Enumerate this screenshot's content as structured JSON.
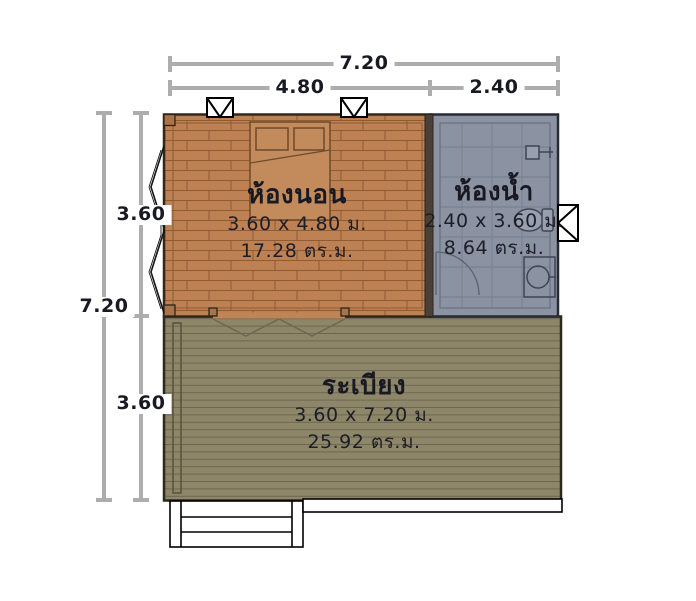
{
  "plan": {
    "dimensions": {
      "top_total": "7.20",
      "top_left": "4.80",
      "top_right": "2.40",
      "left_total": "7.20",
      "left_upper": "3.60",
      "left_lower": "3.60"
    },
    "rooms": {
      "bedroom": {
        "name": "ห้องนอน",
        "size": "3.60 x 4.80 ม.",
        "area": "17.28 ตร.ม.",
        "fill": "#be8153"
      },
      "bathroom": {
        "name": "ห้องน้ำ",
        "size": "2.40 x 3.60 ม.",
        "area": "8.64 ตร.ม.",
        "fill": "#8b93a3"
      },
      "terrace": {
        "name": "ระเบียง",
        "size": "3.60 x 7.20 ม.",
        "area": "25.92 ตร.ม.",
        "fill": "#8d8669"
      }
    },
    "colors": {
      "dimension_line": "#adadad",
      "text": "#191923",
      "brick_line": "#8f5c31",
      "tile_line": "#767e8e",
      "plank_line": "#6e6852",
      "background": "#ffffff"
    },
    "icons": {
      "top_windows": "awning-window-icon",
      "right_window": "awning-window-icon",
      "left_windows": "casement-window-icon",
      "folding_door": "folding-door-icon",
      "bathroom_door": "door-swing-icon",
      "fixtures": [
        "shower-icon",
        "toilet-icon",
        "sink-icon"
      ],
      "furniture": "bed-icon",
      "stairs": "stairs-icon"
    }
  }
}
